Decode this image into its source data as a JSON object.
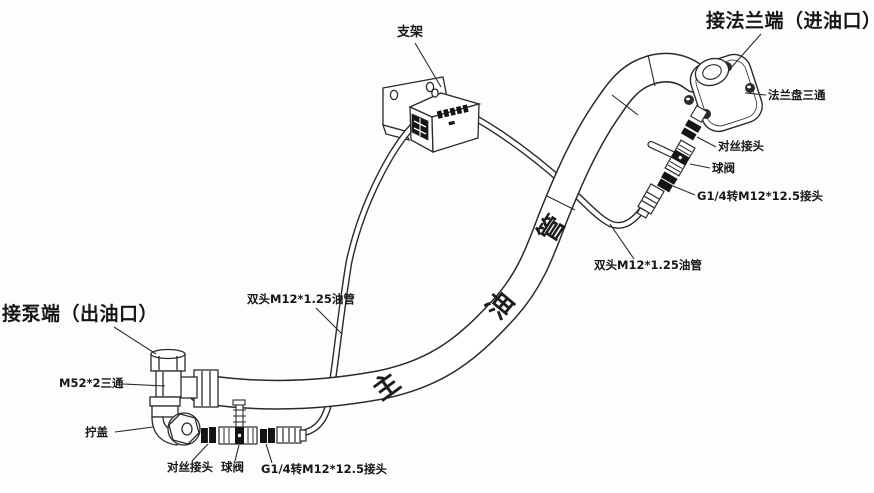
{
  "diagram": {
    "title_labels": {
      "flange_end": "接法兰端（进油口）",
      "pump_end": "接泵端（出油口）"
    },
    "part_labels": {
      "bracket": "支架",
      "flange_tee": "法兰盘三通",
      "nipple_top": "对丝接头",
      "ball_valve_top": "球阀",
      "adapter_top": "G1/4转M12*12.5接头",
      "oil_pipe_right": "双头M12*1.25油管",
      "oil_pipe_left": "双头M12*1.25油管",
      "tee": "M52*2三通",
      "cap": "拧盖",
      "nipple_bottom": "对丝接头",
      "ball_valve_bottom": "球阀",
      "adapter_bottom": "G1/4转M12*12.5接头"
    },
    "main_pipe_chars": [
      "主",
      "油",
      "管"
    ],
    "colors": {
      "line": "#2a2a2a",
      "background": "#fdfdfd",
      "part_fill": "#ffffff",
      "dark_fitting": "#141414"
    }
  }
}
